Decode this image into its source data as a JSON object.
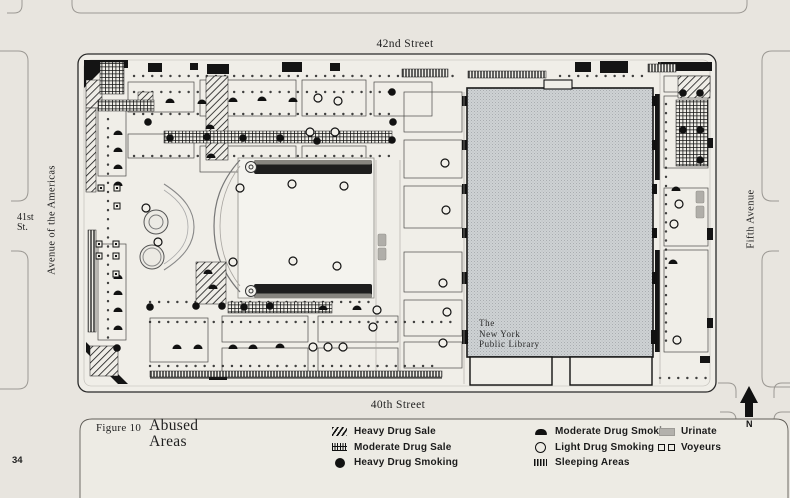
{
  "page": {
    "number": "34"
  },
  "figure": {
    "label": "Figure 10",
    "title_line1": "Abused",
    "title_line2": "Areas"
  },
  "streets": {
    "top": "42nd Street",
    "bottom": "40th Street",
    "left_avenue": "Avenue of the Americas",
    "right_avenue": "Fifth Avenue",
    "left_street_line1": "41st",
    "left_street_line2": "St."
  },
  "library": {
    "line1": "The",
    "line2": "New York",
    "line3": "Public Library"
  },
  "compass": {
    "label": "N"
  },
  "legend": {
    "columns": [
      {
        "items": [
          {
            "symbol": "diagonal-hatch",
            "label": "Heavy Drug Sale"
          },
          {
            "symbol": "crosshatch",
            "label": "Moderate Drug Sale"
          },
          {
            "symbol": "filled-circle",
            "label": "Heavy Drug Smoking"
          }
        ]
      },
      {
        "items": [
          {
            "symbol": "filled-dome",
            "label": "Moderate Drug Smoking"
          },
          {
            "symbol": "open-circle",
            "label": "Light Drug Smoking"
          },
          {
            "symbol": "ladder",
            "label": "Sleeping Areas"
          }
        ]
      },
      {
        "items": [
          {
            "symbol": "gray-block",
            "label": "Urinate"
          },
          {
            "symbol": "open-squares",
            "label": "Voyeurs"
          }
        ]
      }
    ]
  },
  "colors": {
    "page_background": "#e8e5df",
    "map_paper": "#f0eee8",
    "ink": "#161616",
    "library_gray": "#ced2d4",
    "lawn": "#f4f3ee",
    "urinate_gray": "#b0aea9"
  },
  "map": {
    "areas": {
      "format": [
        "type",
        "x",
        "y",
        "w",
        "h"
      ],
      "rects": [
        [
          "sale_heavy",
          86,
          80,
          16,
          28
        ],
        [
          "sale_heavy",
          206,
          76,
          22,
          84
        ],
        [
          "sale_heavy",
          196,
          262,
          30,
          42
        ],
        [
          "sale_heavy",
          138,
          92,
          15,
          14
        ],
        [
          "sale_heavy",
          678,
          76,
          32,
          22
        ],
        [
          "sale_heavy",
          86,
          108,
          10,
          84
        ],
        [
          "sale_heavy",
          90,
          346,
          28,
          30
        ],
        [
          "sale_mod",
          100,
          62,
          24,
          32
        ],
        [
          "sale_mod",
          98,
          100,
          56,
          11
        ],
        [
          "sale_mod",
          164,
          131,
          228,
          12
        ],
        [
          "sale_mod",
          228,
          302,
          104,
          11
        ],
        [
          "sale_mod",
          676,
          100,
          32,
          66
        ],
        [
          "sleep",
          402,
          69,
          46,
          8
        ],
        [
          "sleep",
          468,
          71,
          78,
          7
        ],
        [
          "sleep",
          648,
          64,
          28,
          8
        ],
        [
          "sleep",
          88,
          230,
          8,
          102
        ],
        [
          "sleep",
          150,
          371,
          292,
          6
        ]
      ]
    },
    "markers": {
      "format": [
        "type",
        "x",
        "y"
      ],
      "points": [
        [
          "mod_smoke",
          170,
          101
        ],
        [
          "mod_smoke",
          202,
          102
        ],
        [
          "mod_smoke",
          233,
          100
        ],
        [
          "mod_smoke",
          262,
          99
        ],
        [
          "mod_smoke",
          293,
          100
        ],
        [
          "mod_smoke",
          118,
          133
        ],
        [
          "mod_smoke",
          118,
          150
        ],
        [
          "mod_smoke",
          118,
          167
        ],
        [
          "mod_smoke",
          118,
          184
        ],
        [
          "mod_smoke",
          118,
          277
        ],
        [
          "mod_smoke",
          118,
          293
        ],
        [
          "mod_smoke",
          118,
          310
        ],
        [
          "mod_smoke",
          118,
          328
        ],
        [
          "mod_smoke",
          210,
          127
        ],
        [
          "mod_smoke",
          211,
          156
        ],
        [
          "mod_smoke",
          208,
          272
        ],
        [
          "mod_smoke",
          213,
          287
        ],
        [
          "mod_smoke",
          323,
          308
        ],
        [
          "mod_smoke",
          357,
          308
        ],
        [
          "mod_smoke",
          177,
          347
        ],
        [
          "mod_smoke",
          198,
          347
        ],
        [
          "mod_smoke",
          233,
          347
        ],
        [
          "mod_smoke",
          253,
          347
        ],
        [
          "mod_smoke",
          280,
          346
        ],
        [
          "mod_smoke",
          676,
          189
        ],
        [
          "mod_smoke",
          673,
          262
        ],
        [
          "heavy_smoke",
          170,
          138
        ],
        [
          "heavy_smoke",
          207,
          137
        ],
        [
          "heavy_smoke",
          243,
          138
        ],
        [
          "heavy_smoke",
          280,
          138
        ],
        [
          "heavy_smoke",
          317,
          141
        ],
        [
          "heavy_smoke",
          392,
          92
        ],
        [
          "heavy_smoke",
          393,
          122
        ],
        [
          "heavy_smoke",
          392,
          140
        ],
        [
          "heavy_smoke",
          683,
          93
        ],
        [
          "heavy_smoke",
          700,
          93
        ],
        [
          "heavy_smoke",
          683,
          130
        ],
        [
          "heavy_smoke",
          700,
          130
        ],
        [
          "heavy_smoke",
          700,
          160
        ],
        [
          "heavy_smoke",
          117,
          348
        ],
        [
          "heavy_smoke",
          150,
          307
        ],
        [
          "heavy_smoke",
          196,
          306
        ],
        [
          "heavy_smoke",
          222,
          306
        ],
        [
          "heavy_smoke",
          244,
          307
        ],
        [
          "heavy_smoke",
          270,
          306
        ],
        [
          "heavy_smoke",
          148,
          122
        ],
        [
          "light_smoke",
          318,
          98
        ],
        [
          "light_smoke",
          338,
          101
        ],
        [
          "light_smoke",
          310,
          132
        ],
        [
          "light_smoke",
          335,
          132
        ],
        [
          "light_smoke",
          240,
          188
        ],
        [
          "light_smoke",
          292,
          184
        ],
        [
          "light_smoke",
          344,
          186
        ],
        [
          "light_smoke",
          233,
          262
        ],
        [
          "light_smoke",
          293,
          261
        ],
        [
          "light_smoke",
          337,
          266
        ],
        [
          "light_smoke",
          146,
          208
        ],
        [
          "light_smoke",
          158,
          242
        ],
        [
          "light_smoke",
          377,
          310
        ],
        [
          "light_smoke",
          373,
          327
        ],
        [
          "light_smoke",
          313,
          347
        ],
        [
          "light_smoke",
          328,
          347
        ],
        [
          "light_smoke",
          343,
          347
        ],
        [
          "light_smoke",
          445,
          163
        ],
        [
          "light_smoke",
          446,
          210
        ],
        [
          "light_smoke",
          443,
          283
        ],
        [
          "light_smoke",
          447,
          312
        ],
        [
          "light_smoke",
          443,
          343
        ],
        [
          "light_smoke",
          679,
          204
        ],
        [
          "light_smoke",
          674,
          224
        ],
        [
          "light_smoke",
          677,
          340
        ],
        [
          "voyeur",
          101,
          188
        ],
        [
          "voyeur",
          117,
          188
        ],
        [
          "voyeur",
          117,
          206
        ],
        [
          "voyeur",
          99,
          244
        ],
        [
          "voyeur",
          116,
          244
        ],
        [
          "voyeur",
          99,
          256
        ],
        [
          "voyeur",
          116,
          256
        ],
        [
          "voyeur",
          116,
          274
        ],
        [
          "urinate",
          382,
          240
        ],
        [
          "urinate",
          382,
          254
        ],
        [
          "urinate",
          700,
          197
        ],
        [
          "urinate",
          700,
          212
        ]
      ]
    }
  }
}
